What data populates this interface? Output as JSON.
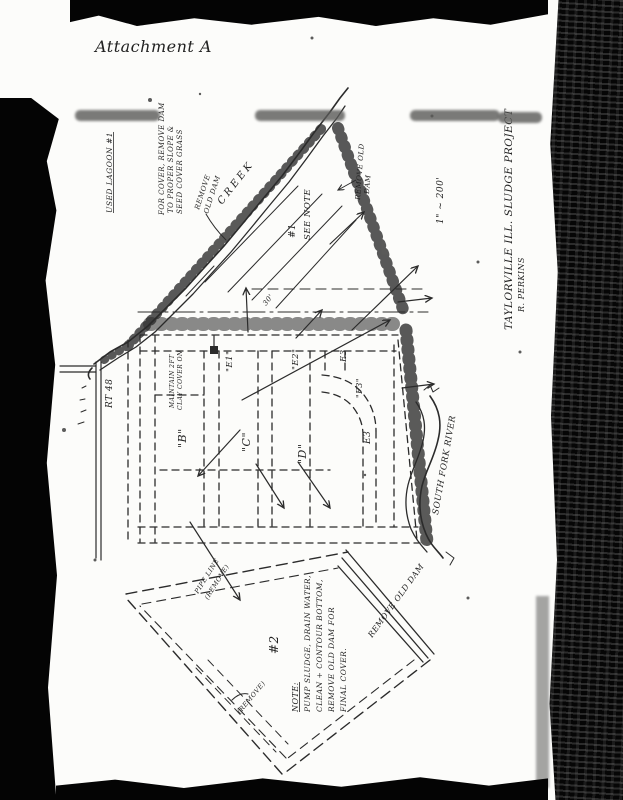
{
  "document": {
    "attachment_label": "Attachment A",
    "title_block": {
      "title": "TAYLORVILLE ILL. SLUDGE PROJECT",
      "author": "R. PERKINS"
    },
    "scale_note": "1\" ~ 200'",
    "creek_label": "CREEK",
    "river_label": "SOUTH FORK RIVER",
    "road_label": "RT 48",
    "lagoon1": {
      "heading": "USED LAGOON #1",
      "note_line1": "FOR COVER, REMOVE DAM",
      "note_line2": "TO PROPER SLOPE &",
      "note_line3": "SEED COVER GRASS",
      "marker": "#1",
      "see_note": "SEE NOTE",
      "maintain_line1": "MAINTAIN 2FT",
      "maintain_line2": "CLAY COVER ON",
      "dim_note": "30'",
      "cells": {
        "b": "\"B\"",
        "c": "\"C\"",
        "d": "\"D\"",
        "e1": "\"E1\"",
        "e2": "\"E2\"",
        "e3_top": "E3",
        "f3": "\"F3\"",
        "e3_low": "E3"
      }
    },
    "lagoon2": {
      "marker": "#2",
      "note_heading": "NOTE:",
      "note_line1": "PUMP SLUDGE, DRAIN WATER,",
      "note_line2": "CLEAN + CONTOUR BOTTOM,",
      "note_line3": "REMOVE OLD DAM FOR",
      "note_line4": "FINAL COVER.",
      "remove_dam_diag": "REMOVE OLD DAM",
      "remove_small": "(REMOVE)",
      "pipe_line1": "PIPE LINE",
      "pipe_line2": "(REMOVE)"
    },
    "remove_old_dam_left": {
      "line1": "REMOVE",
      "line2": "OLD DAM"
    },
    "remove_old_dam_right": {
      "line1": "REMOVE OLD",
      "line2": "DAM"
    }
  },
  "colors": {
    "ink": "#2b2b2b",
    "paper": "#fcfcfa",
    "scan_black": "#040404"
  }
}
